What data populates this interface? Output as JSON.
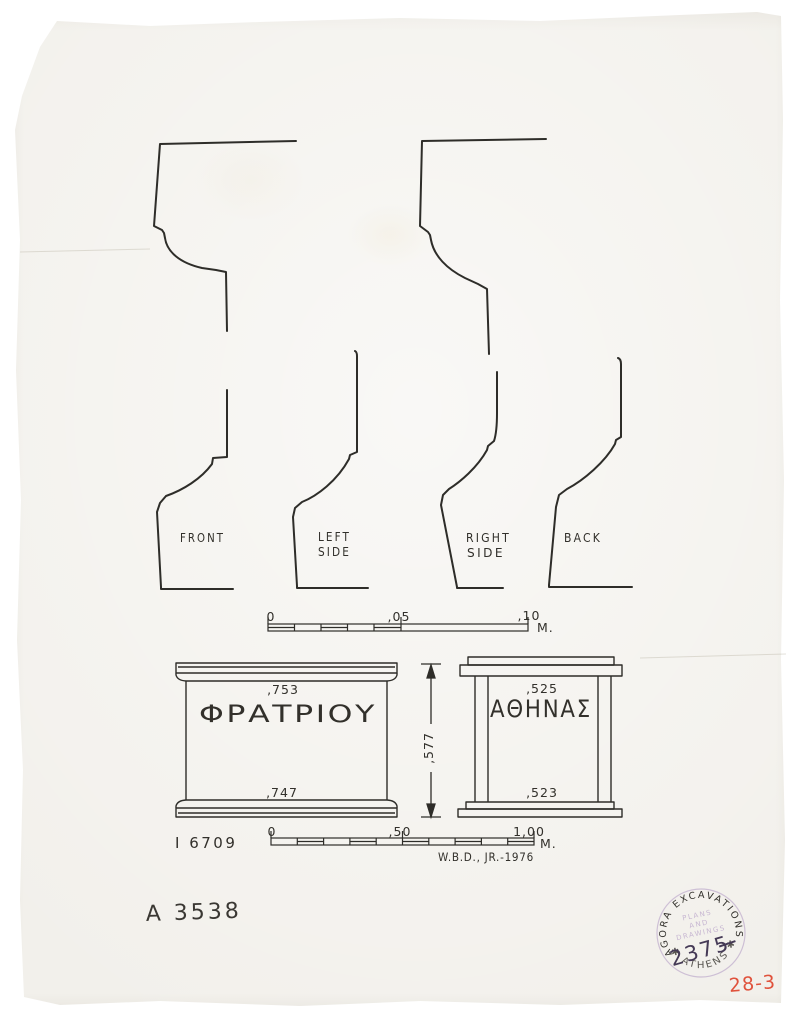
{
  "page": {
    "background": "#ffffff",
    "paper_color": "#f2f0eb",
    "ink_color": "#32302b"
  },
  "profiles": {
    "front_label": "FRONT",
    "left_side_label_line1": "LEFT",
    "left_side_label_line2": "SIDE",
    "right_side_label_line1": "RIGHT",
    "right_side_label_line2": "SIDE",
    "back_label": "BACK"
  },
  "scale_small": {
    "tick_zero": "0",
    "tick_mid": ",05",
    "tick_end": ",10",
    "unit": "M."
  },
  "scale_large": {
    "tick_zero": "0",
    "tick_mid": ",50",
    "tick_end": "1,00",
    "unit": "M."
  },
  "front_elevation": {
    "inscription": "ΦΡΑΤΡΙΟΥ",
    "top_width": ",753",
    "bottom_width": ",747"
  },
  "side_elevation": {
    "inscription": "ΑΘΗΝΑΣ",
    "top_width": ",525",
    "bottom_width": ",523"
  },
  "height_dimension": ",577",
  "annotations": {
    "inventory_number": "I 6709",
    "signature": "W.B.D., JR.-1976",
    "catalog_number": "A 3538",
    "page_number": "28-3"
  },
  "stamp": {
    "ring_text": "AGORA EXCAVATIONS",
    "bottom_arc_text": "✱ ATHENS ✱",
    "center_line1": "PLANS",
    "center_line2": "AND",
    "center_line3": "DRAWINGS",
    "number": "2375",
    "color": "#8a65ad"
  }
}
